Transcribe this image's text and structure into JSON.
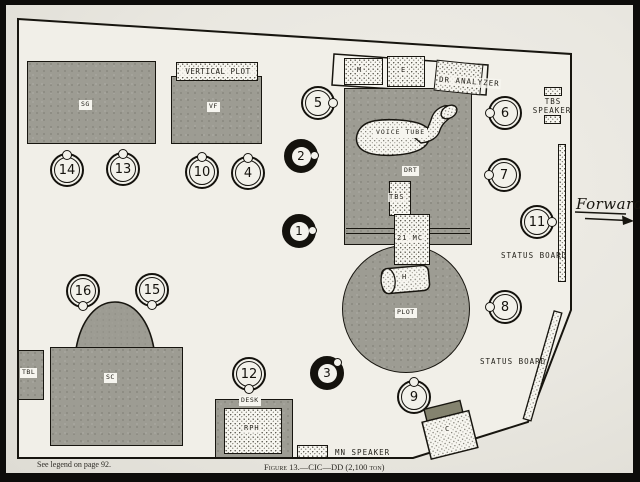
{
  "page": {
    "caption_left": "See legend on page 92.",
    "caption_figure": "Figure 13.—CIC—DD (2,100 ton)",
    "forward_label": "Forward"
  },
  "equipment": {
    "sg": "SG",
    "vf": "VF",
    "vertical_plot": "VERTICAL PLOT",
    "m": "M",
    "e": "E",
    "dr_analyzer": "DR ANALYZER",
    "voice_tube": "VOICE TUBE",
    "drt": "DRT",
    "tbs": "TBS",
    "mc_21": "21 MC",
    "h": "H",
    "plot": "PLOT",
    "tbs_speaker_line1": "TBS",
    "tbs_speaker_line2": "SPEAKER",
    "status_board_upper": "STATUS BOARD",
    "status_board_lower": "STATUS BOARD",
    "sc": "SC",
    "tbl": "TBL",
    "desk": "DESK",
    "rph": "RPH",
    "c": "C",
    "mn_speaker": "MN SPEAKER"
  },
  "stations": [
    {
      "number": "14",
      "style": "open",
      "facing": "up"
    },
    {
      "number": "13",
      "style": "open",
      "facing": "up"
    },
    {
      "number": "10",
      "style": "open",
      "facing": "up"
    },
    {
      "number": "4",
      "style": "open",
      "facing": "up"
    },
    {
      "number": "5",
      "style": "open",
      "facing": "right"
    },
    {
      "number": "2",
      "style": "filled",
      "facing": "right"
    },
    {
      "number": "1",
      "style": "filled",
      "facing": "right"
    },
    {
      "number": "6",
      "style": "open",
      "facing": "left"
    },
    {
      "number": "7",
      "style": "open",
      "facing": "left"
    },
    {
      "number": "11",
      "style": "open",
      "facing": "right"
    },
    {
      "number": "8",
      "style": "open",
      "facing": "left"
    },
    {
      "number": "16",
      "style": "open",
      "facing": "down"
    },
    {
      "number": "15",
      "style": "open",
      "facing": "down"
    },
    {
      "number": "12",
      "style": "open",
      "facing": "down"
    },
    {
      "number": "3",
      "style": "filled",
      "facing": "upright"
    },
    {
      "number": "9",
      "style": "open",
      "facing": "up"
    }
  ],
  "colors": {
    "ink": "#17150f",
    "paper": "#e9e7e0",
    "floor": "#f1efe8",
    "console_gray": "#9d9c93",
    "stipple_bg": "#f7f6f0",
    "frame": "#0d0c0a"
  }
}
